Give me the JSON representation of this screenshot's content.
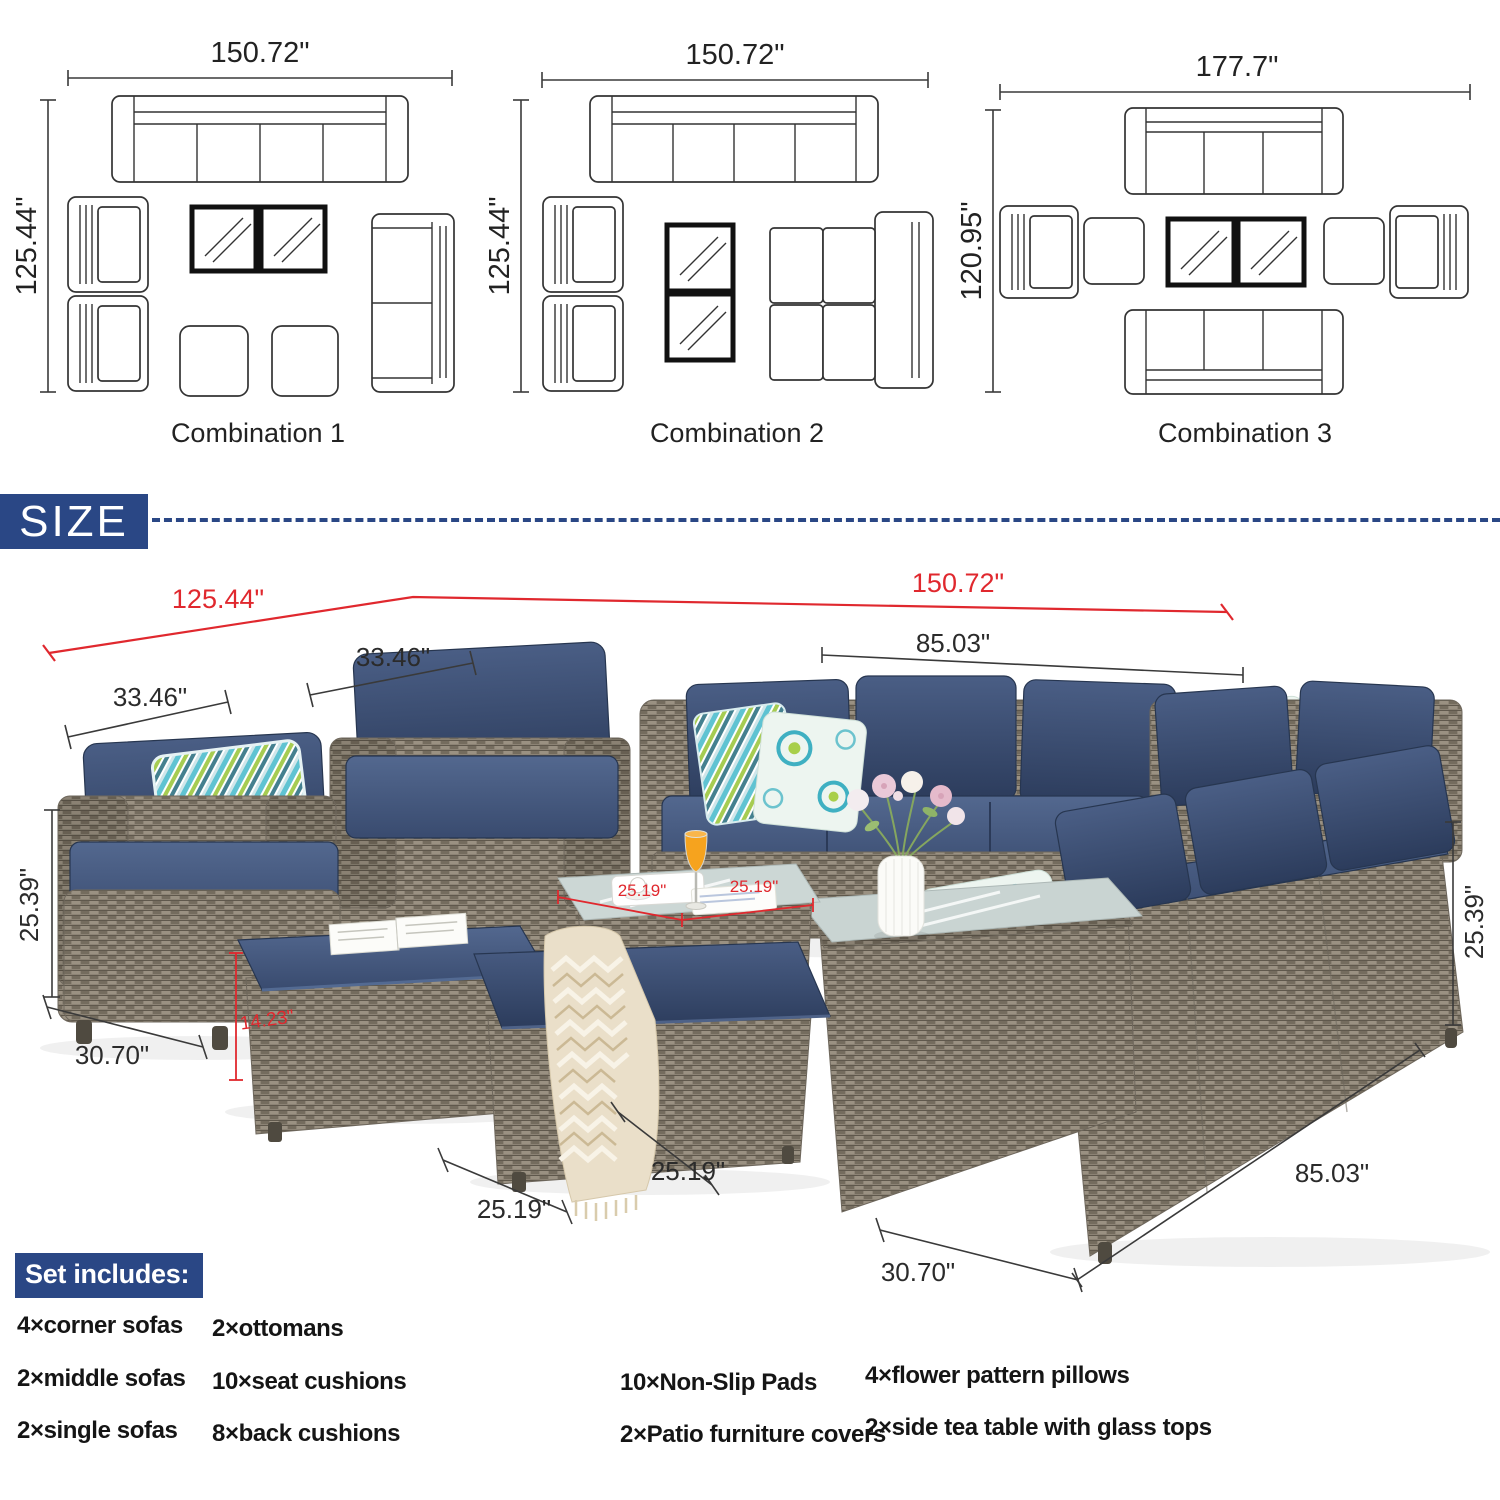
{
  "colors": {
    "badge_blue": "#2a4785",
    "dim_red": "#e0282e",
    "dim_black": "#3a3a3a",
    "wicker": "#8c8375",
    "cushion_navy": "#35486b"
  },
  "combinations": [
    {
      "label": "Combination 1",
      "width_dim": "150.72\"",
      "height_dim": "125.44\""
    },
    {
      "label": "Combination 2",
      "width_dim": "150.72\"",
      "height_dim": "125.44\""
    },
    {
      "label": "Combination 3",
      "width_dim": "177.7\"",
      "height_dim": "120.95\""
    }
  ],
  "size_badge": "SIZE",
  "scene_dims": {
    "overall_width_left": "125.44\"",
    "overall_width_right": "150.72\"",
    "single_sofa_width_back": "33.46\"",
    "single_sofa_width_front": "33.46\"",
    "sofa_length_top": "85.03\"",
    "sofa_height_left": "25.39\"",
    "single_sofa_depth_left": "30.70\"",
    "ottoman_height_red": "14.23\"",
    "ottoman_width_front": "25.19\"",
    "ottoman_width_side": "25.19\"",
    "table_top_width_red": "25.19\"",
    "table_top_depth_red": "25.19\"",
    "corner_depth_bottom": "30.70\"",
    "sofa_length_right": "85.03\"",
    "sofa_height_right": "25.39\""
  },
  "set_includes": {
    "header": "Set includes:",
    "items": [
      "4×corner sofas",
      "2×middle sofas",
      "2×single sofas",
      "2×ottomans",
      "10×seat cushions",
      "8×back cushions",
      "10×Non-Slip Pads",
      "2×Patio furniture covers",
      "4×flower pattern pillows",
      "2×side tea table with glass tops"
    ]
  }
}
